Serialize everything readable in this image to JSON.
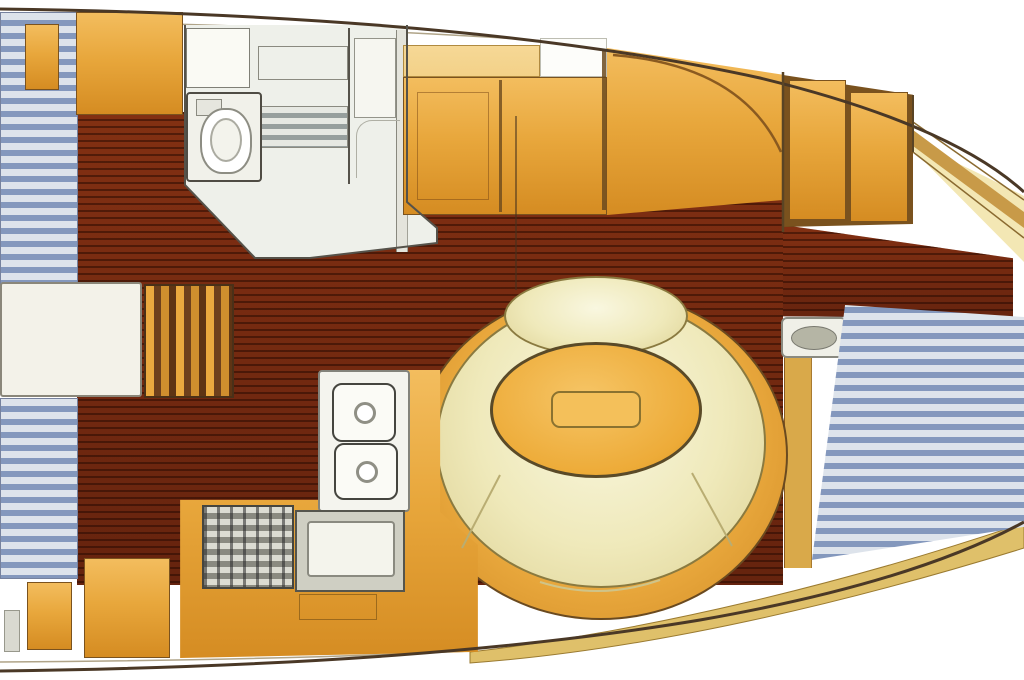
{
  "image_type": "sailboat-interior-floor-plan",
  "view": "top-down deck plan, bow pointing right, no visible text labels",
  "palette": {
    "background": "#ffffff",
    "hull_line": "#4a3826",
    "wood": "#7c2c12",
    "wood_dark": "#5a1e0c",
    "cabinet_orange": "#e8a73c",
    "cabinet_orange_light": "#f3d188",
    "table_orange": "#edab38",
    "cushion_cream": "#efe9ba",
    "berth_stripe_blue": "#8498bd",
    "berth_stripe_white": "#dde3eb",
    "shelf_cream": "#f3e7b4",
    "trim_tan": "#dfc06a",
    "fixture_white": "#f2f2ec",
    "fixture_gray": "#9aa0a0"
  },
  "areas": [
    {
      "name": "aft-berth-upper",
      "finish": "blue-white striped mattress"
    },
    {
      "name": "aft-berth-lower",
      "finish": "blue-white striped mattress"
    },
    {
      "name": "companionway-steps",
      "finish": "wood treads"
    },
    {
      "name": "engine-box",
      "finish": "white panel"
    },
    {
      "name": "head-compartment",
      "fixtures": [
        "locker",
        "shelf",
        "vent-grate",
        "toilet",
        "shower-panels"
      ]
    },
    {
      "name": "salon-cabinets",
      "finish": "orange-varnished joinery"
    },
    {
      "name": "circular-dinette",
      "fixtures": [
        "u-settee-cushions",
        "oval-table",
        "table-leaf-inset"
      ]
    },
    {
      "name": "galley",
      "fixtures": [
        "two-burner-stove",
        "oven-control-panel",
        "sink",
        "locker-door"
      ]
    },
    {
      "name": "forward-cabin",
      "fixtures": [
        "wardrobe-doors",
        "seat-pad",
        "v-berth"
      ]
    },
    {
      "name": "cabin-sole",
      "finish": "teak-and-holly planks"
    },
    {
      "name": "hull",
      "finish": "white with cream shelf trim"
    }
  ]
}
